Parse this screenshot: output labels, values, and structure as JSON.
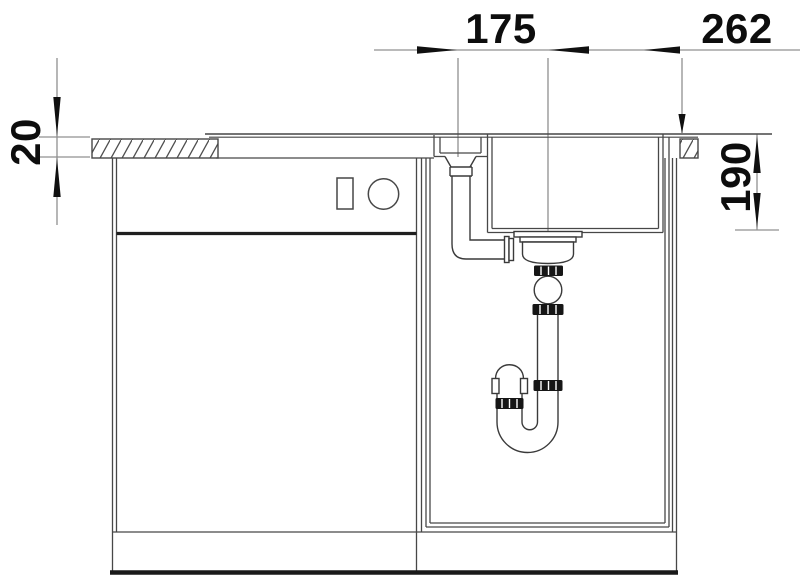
{
  "dimensions": {
    "dim_175": {
      "label": "175",
      "orientation": "horizontal"
    },
    "dim_262": {
      "label": "262",
      "orientation": "horizontal"
    },
    "dim_20": {
      "label": "20",
      "orientation": "vertical"
    },
    "dim_190": {
      "label": "190",
      "orientation": "vertical"
    }
  },
  "colors": {
    "background": "#ffffff",
    "drawing_line": "#474747",
    "dimension_line": "#909090",
    "annotation": "#0d0d0d",
    "fitting_dark": "#161616"
  }
}
